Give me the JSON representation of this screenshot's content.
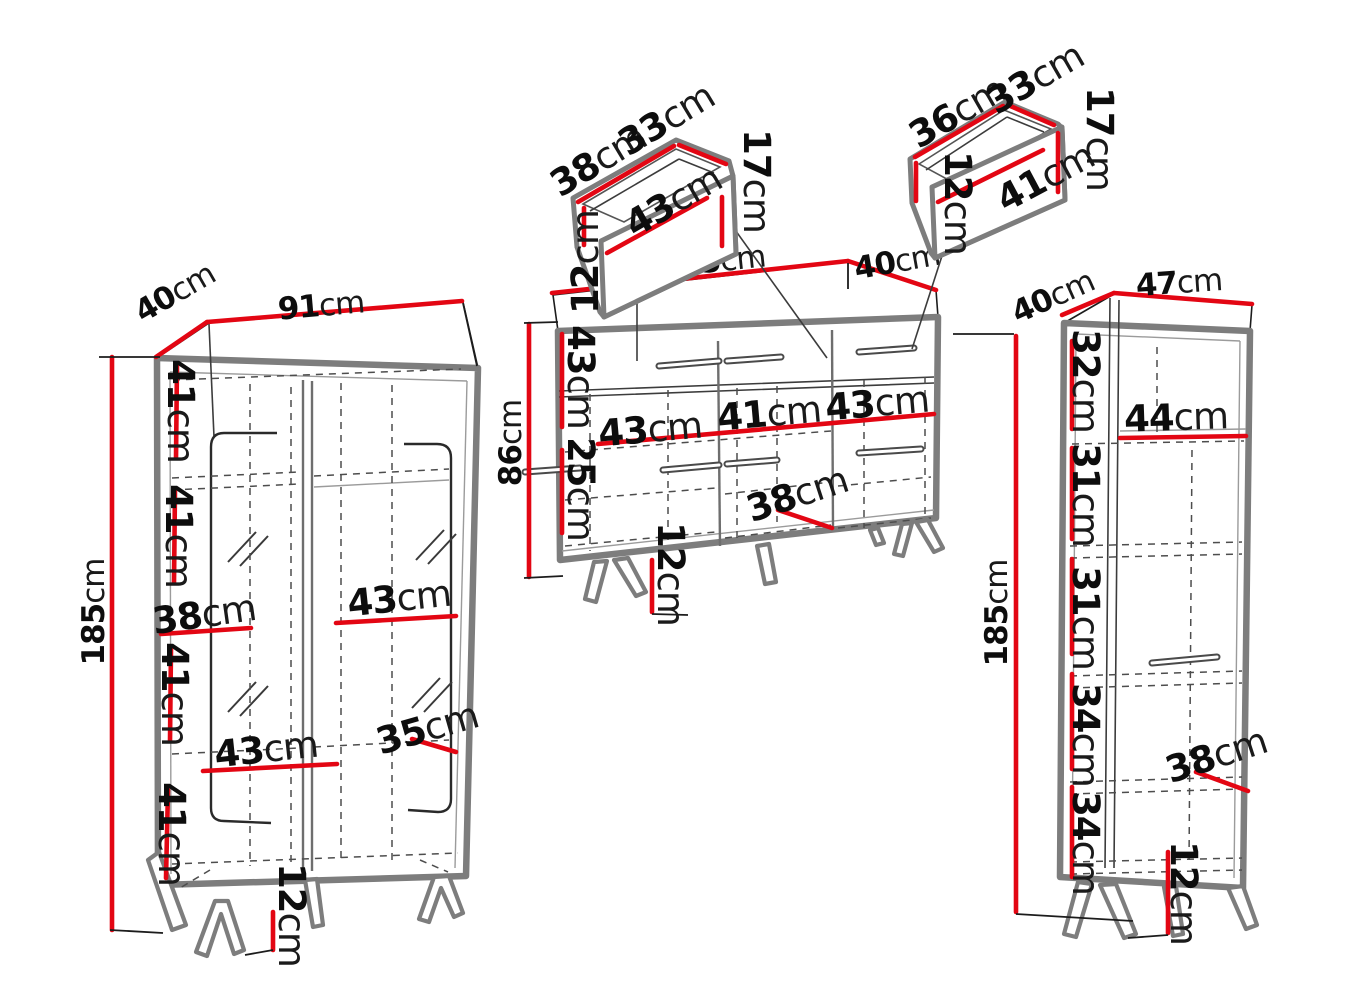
{
  "diagram": {
    "unit": "cm",
    "colors": {
      "dimension_red": "#e30613",
      "outline_gray": "#7d7d7d",
      "line_black": "#1c1c1c"
    }
  },
  "drawer_left": {
    "depth": {
      "v": "38",
      "u": "cm"
    },
    "back_width": {
      "v": "33",
      "u": "cm"
    },
    "height": {
      "v": "17",
      "u": "cm"
    },
    "front_width": {
      "v": "43",
      "u": "cm"
    },
    "front_height": {
      "v": "12",
      "u": "cm"
    }
  },
  "drawer_right": {
    "depth": {
      "v": "36",
      "u": "cm"
    },
    "back_width": {
      "v": "33",
      "u": "cm"
    },
    "height": {
      "v": "17",
      "u": "cm"
    },
    "front_width": {
      "v": "41",
      "u": "cm"
    },
    "front_height": {
      "v": "12",
      "u": "cm"
    }
  },
  "cabinet_left": {
    "depth": {
      "v": "40",
      "u": "cm"
    },
    "width": {
      "v": "91",
      "u": "cm"
    },
    "height": {
      "v": "185",
      "u": "cm"
    },
    "section_1": {
      "v": "41",
      "u": "cm"
    },
    "section_2": {
      "v": "41",
      "u": "cm"
    },
    "shelf_left_width": {
      "v": "38",
      "u": "cm"
    },
    "shelf_right_width": {
      "v": "43",
      "u": "cm"
    },
    "section_3": {
      "v": "41",
      "u": "cm"
    },
    "shelf_lower_width": {
      "v": "43",
      "u": "cm"
    },
    "shelf_depth": {
      "v": "35",
      "u": "cm"
    },
    "section_4": {
      "v": "41",
      "u": "cm"
    },
    "leg_height": {
      "v": "12",
      "u": "cm"
    }
  },
  "sideboard": {
    "width": {
      "v": "135",
      "u": "cm"
    },
    "depth": {
      "v": "40",
      "u": "cm"
    },
    "height": {
      "v": "86",
      "u": "cm"
    },
    "top_section_height": {
      "v": "43",
      "u": "cm"
    },
    "bottom_section_height": {
      "v": "25",
      "u": "cm"
    },
    "inner_left_width": {
      "v": "43",
      "u": "cm"
    },
    "inner_middle_width": {
      "v": "41",
      "u": "cm"
    },
    "inner_right_width": {
      "v": "43",
      "u": "cm"
    },
    "inner_depth": {
      "v": "38",
      "u": "cm"
    },
    "leg_height": {
      "v": "12",
      "u": "cm"
    }
  },
  "cabinet_right": {
    "depth": {
      "v": "40",
      "u": "cm"
    },
    "width": {
      "v": "47",
      "u": "cm"
    },
    "height": {
      "v": "185",
      "u": "cm"
    },
    "section_1": {
      "v": "32",
      "u": "cm"
    },
    "shelf_width": {
      "v": "44",
      "u": "cm"
    },
    "section_2": {
      "v": "31",
      "u": "cm"
    },
    "section_3": {
      "v": "31",
      "u": "cm"
    },
    "section_4": {
      "v": "34",
      "u": "cm"
    },
    "shelf_depth": {
      "v": "38",
      "u": "cm"
    },
    "section_5": {
      "v": "34",
      "u": "cm"
    },
    "leg_height": {
      "v": "12",
      "u": "cm"
    }
  }
}
